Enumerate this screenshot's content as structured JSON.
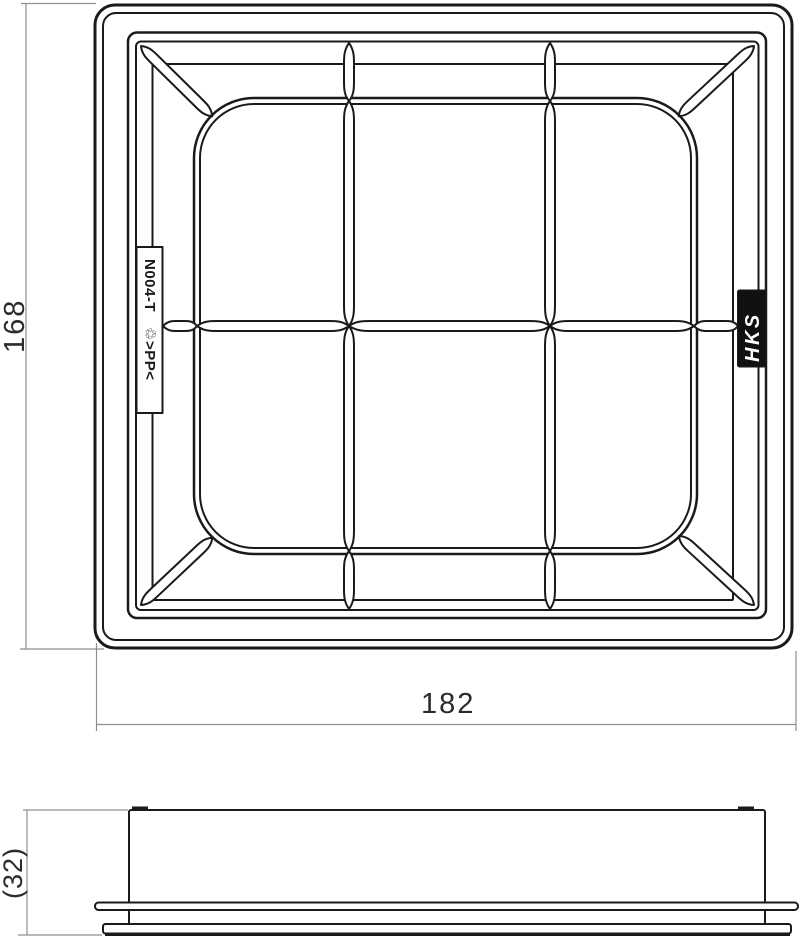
{
  "top_view": {
    "part_number": "N004-T",
    "material_mark": "♲>PP<",
    "brand_logo": "HKS"
  },
  "dimensions": {
    "height": "168",
    "width": "182",
    "side_height": "(32)"
  },
  "colors": {
    "background": "#ffffff",
    "line": "#1a1a1a",
    "dim_line": "#8f8f8f",
    "dim_text": "#2b2b2b",
    "logo_bg": "#111111",
    "logo_text": "#ffffff"
  }
}
